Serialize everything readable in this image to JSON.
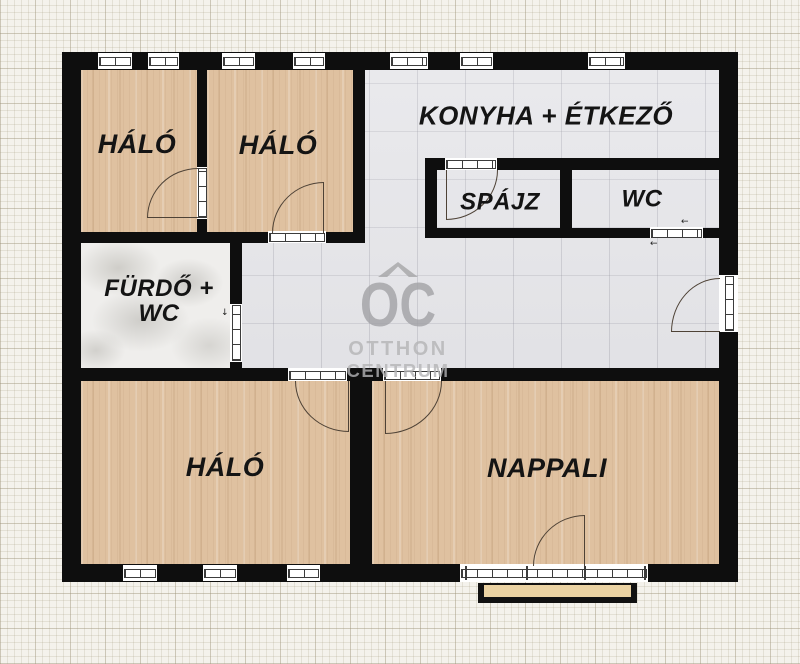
{
  "plan": {
    "rooms": [
      {
        "id": "bedroom-top-left",
        "label": "HÁLÓ"
      },
      {
        "id": "bedroom-top-mid",
        "label": "HÁLÓ"
      },
      {
        "id": "kitchen-dining",
        "label": "KONYHA + ÉTKEZŐ"
      },
      {
        "id": "pantry",
        "label": "SPÁJZ"
      },
      {
        "id": "wc",
        "label": "WC"
      },
      {
        "id": "bathroom",
        "label_line1": "FÜRDŐ +",
        "label_line2": "WC"
      },
      {
        "id": "bedroom-bottom",
        "label": "HÁLÓ"
      },
      {
        "id": "living-room",
        "label": "NAPPALI"
      }
    ],
    "watermark": {
      "monogram": "OC",
      "name_line1": "OTTHON",
      "name_line2": "CENTRUM"
    },
    "symbols": {
      "slide_arrow": "←",
      "swing_arrow": "↓"
    },
    "colors": {
      "wall": "#0e0e0e",
      "wood_floor": "#dfc1a0",
      "tile_floor": "#e4e4e8",
      "marble_floor": "#efeeec",
      "balcony": "#ead2a2",
      "paper": "#f4f2ec",
      "watermark_gray": "#a2a2a6"
    }
  }
}
